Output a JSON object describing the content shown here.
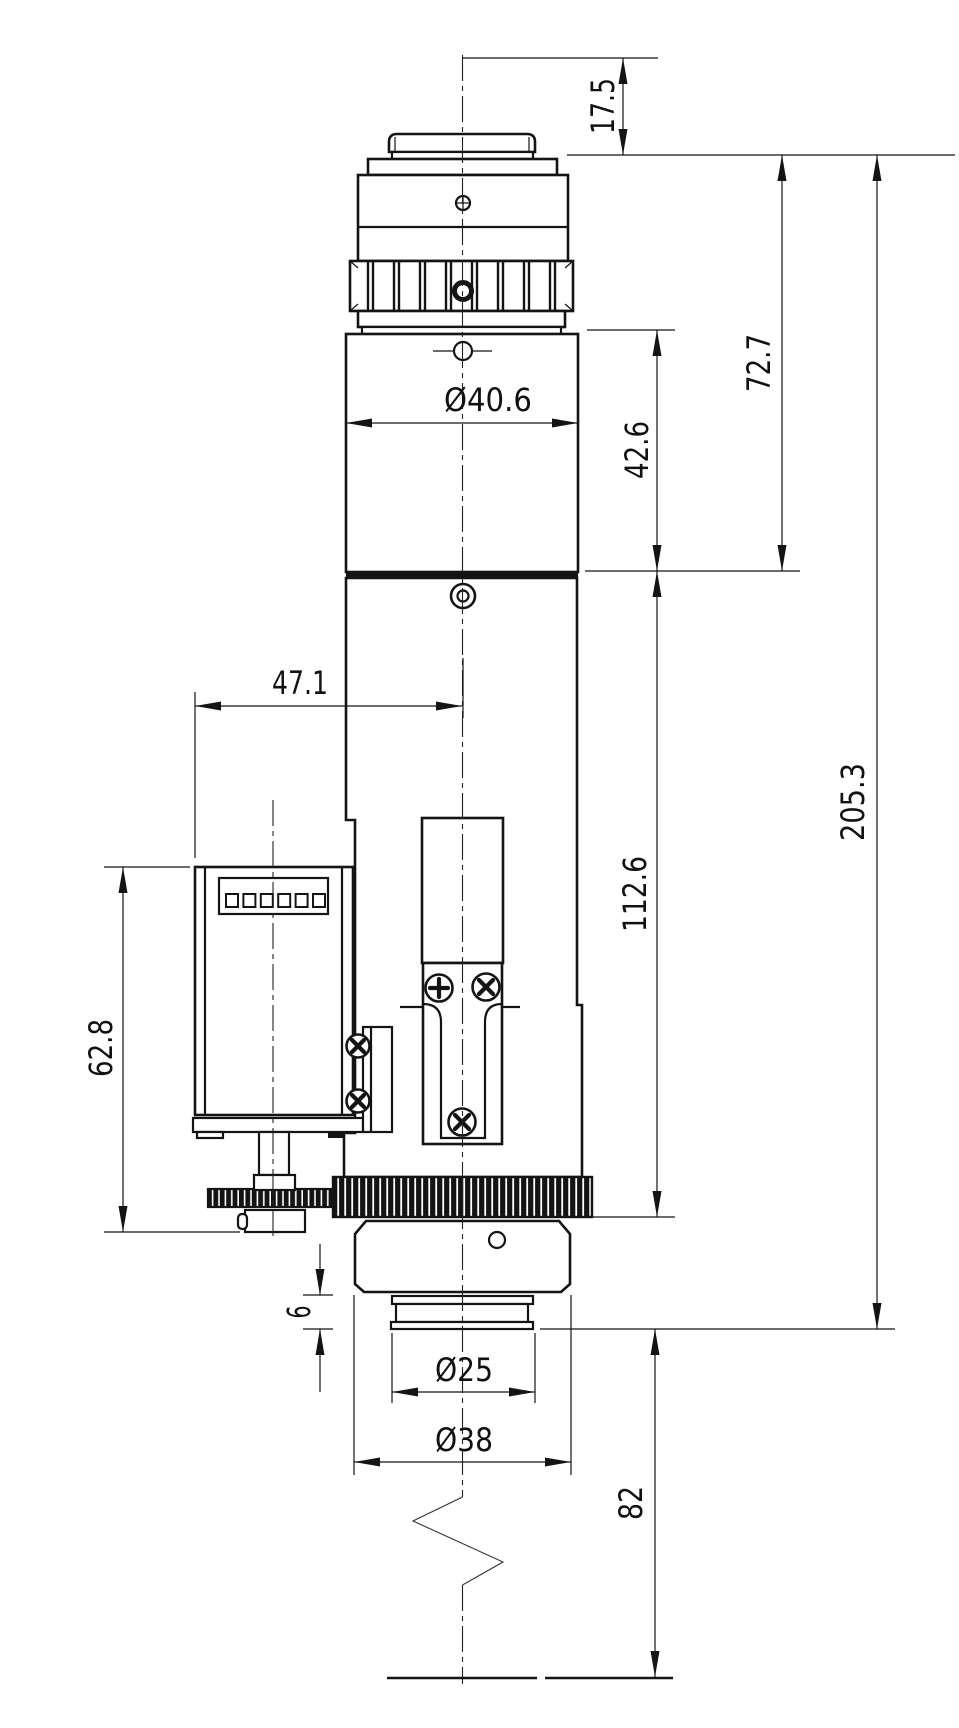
{
  "drawing": {
    "kind": "mechanical dimension drawing",
    "colors": {
      "line": "#141414",
      "background": "#ffffff"
    }
  },
  "dimensions": {
    "top_offset": "17.5",
    "upper_body_length": "72.7",
    "knurl_section_length": "42.6",
    "body_diameter": "Ø40.6",
    "motor_axis_offset": "47.1",
    "lower_body_length": "112.6",
    "motor_assembly_height": "62.8",
    "overall_length": "205.3",
    "spigot_step_height": "6",
    "spigot_diameter": "Ø25",
    "mount_diameter": "Ø38",
    "below_mount_length": "82"
  }
}
